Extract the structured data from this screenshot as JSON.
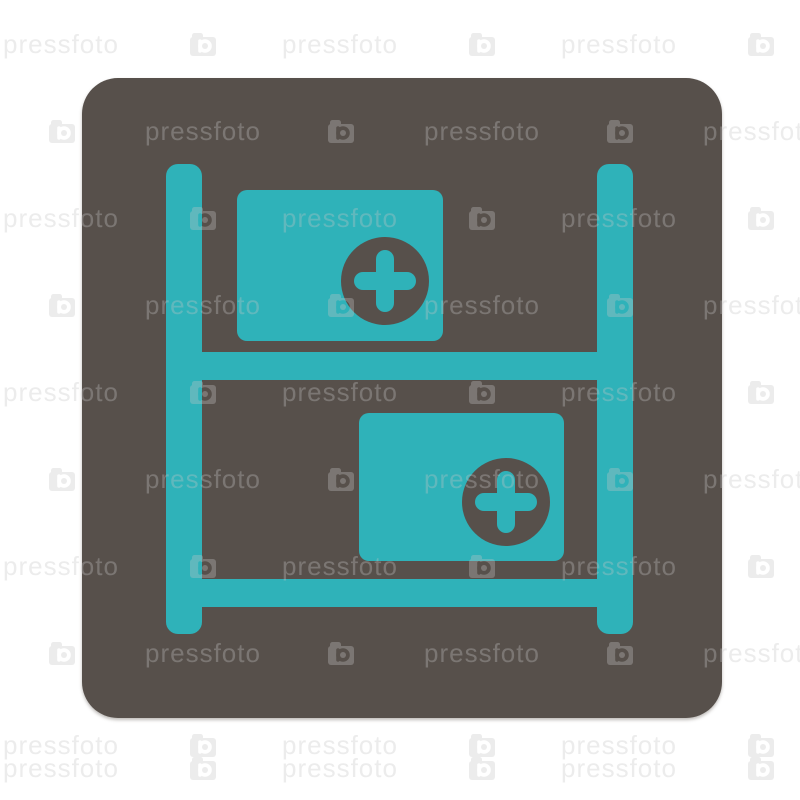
{
  "image": {
    "description": "watermarked stock image of a flat medical warehouse icon on a rounded square button",
    "background": "#ffffff",
    "width": 800,
    "height": 800
  },
  "button": {
    "name": "rounded-square-button",
    "fill": "#57504B",
    "shadow": "rgba(110,104,98,0.45)"
  },
  "glyph": {
    "name": "medical-warehouse-shelf",
    "color": "#2FB2B9",
    "cross_circle_color": "#57504B",
    "parts": [
      "left-post",
      "right-post",
      "middle-shelf-bar",
      "bottom-shelf-bar",
      "top-medical-box",
      "bottom-medical-box",
      "plus-cross-top",
      "plus-cross-bottom"
    ]
  },
  "watermark": {
    "text": "pressfoto",
    "icon": "pressfoto-camera-logo",
    "color": "rgba(196,196,196,0.33)",
    "rows": [
      {
        "y": 33,
        "items": [
          {
            "t": "text",
            "x": 3
          },
          {
            "t": "icon",
            "x": 189
          },
          {
            "t": "text",
            "x": 282
          },
          {
            "t": "icon",
            "x": 468
          },
          {
            "t": "text",
            "x": 561
          },
          {
            "t": "icon",
            "x": 747
          }
        ]
      },
      {
        "y": 120,
        "items": [
          {
            "t": "icon",
            "x": 48
          },
          {
            "t": "text",
            "x": 145
          },
          {
            "t": "icon",
            "x": 327
          },
          {
            "t": "text",
            "x": 424
          },
          {
            "t": "icon",
            "x": 606
          },
          {
            "t": "text",
            "x": 703
          }
        ]
      },
      {
        "y": 207,
        "items": [
          {
            "t": "text",
            "x": 3
          },
          {
            "t": "icon",
            "x": 189
          },
          {
            "t": "text",
            "x": 282
          },
          {
            "t": "icon",
            "x": 468
          },
          {
            "t": "text",
            "x": 561
          },
          {
            "t": "icon",
            "x": 747
          }
        ]
      },
      {
        "y": 294,
        "items": [
          {
            "t": "icon",
            "x": 48
          },
          {
            "t": "text",
            "x": 145
          },
          {
            "t": "icon",
            "x": 327
          },
          {
            "t": "text",
            "x": 424
          },
          {
            "t": "icon",
            "x": 606
          },
          {
            "t": "text",
            "x": 703
          }
        ]
      },
      {
        "y": 381,
        "items": [
          {
            "t": "text",
            "x": 3
          },
          {
            "t": "icon",
            "x": 189
          },
          {
            "t": "text",
            "x": 282
          },
          {
            "t": "icon",
            "x": 468
          },
          {
            "t": "text",
            "x": 561
          },
          {
            "t": "icon",
            "x": 747
          }
        ]
      },
      {
        "y": 468,
        "items": [
          {
            "t": "icon",
            "x": 48
          },
          {
            "t": "text",
            "x": 145
          },
          {
            "t": "icon",
            "x": 327
          },
          {
            "t": "text",
            "x": 424
          },
          {
            "t": "icon",
            "x": 606
          },
          {
            "t": "text",
            "x": 703
          }
        ]
      },
      {
        "y": 555,
        "items": [
          {
            "t": "text",
            "x": 3
          },
          {
            "t": "icon",
            "x": 189
          },
          {
            "t": "text",
            "x": 282
          },
          {
            "t": "icon",
            "x": 468
          },
          {
            "t": "text",
            "x": 561
          },
          {
            "t": "icon",
            "x": 747
          }
        ]
      },
      {
        "y": 642,
        "items": [
          {
            "t": "icon",
            "x": 48
          },
          {
            "t": "text",
            "x": 145
          },
          {
            "t": "icon",
            "x": 327
          },
          {
            "t": "text",
            "x": 424
          },
          {
            "t": "icon",
            "x": 606
          },
          {
            "t": "text",
            "x": 703
          }
        ]
      },
      {
        "y": 734,
        "items": [
          {
            "t": "text",
            "x": 3
          },
          {
            "t": "icon",
            "x": 189
          },
          {
            "t": "text",
            "x": 282
          },
          {
            "t": "icon",
            "x": 468
          },
          {
            "t": "text",
            "x": 561
          },
          {
            "t": "icon",
            "x": 747
          }
        ]
      },
      {
        "y": 757,
        "items": [
          {
            "t": "text",
            "x": 3
          },
          {
            "t": "icon",
            "x": 189
          },
          {
            "t": "text",
            "x": 282
          },
          {
            "t": "icon",
            "x": 468
          },
          {
            "t": "text",
            "x": 561
          },
          {
            "t": "icon",
            "x": 747
          }
        ]
      }
    ]
  }
}
